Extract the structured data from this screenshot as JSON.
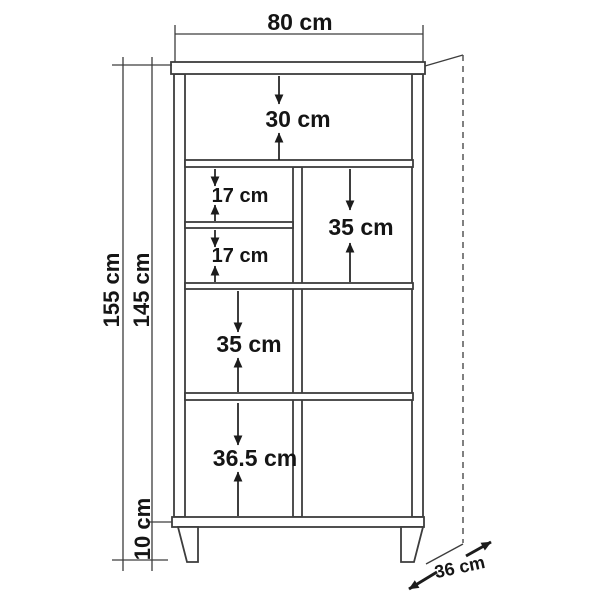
{
  "diagram": {
    "labels": {
      "top_width": "80 cm",
      "top_section_height": "30 cm",
      "left_compartment_1": "17 cm",
      "left_compartment_2": "17 cm",
      "right_compartment": "35 cm",
      "left_middle_compartment": "35 cm",
      "left_bottom_compartment": "36.5 cm",
      "total_height": "155 cm",
      "carcass_height": "145 cm",
      "leg_height": "10 cm",
      "depth": "36 cm"
    },
    "colors": {
      "line": "#3d3d3d",
      "text": "#151515",
      "background": "#ffffff"
    }
  }
}
